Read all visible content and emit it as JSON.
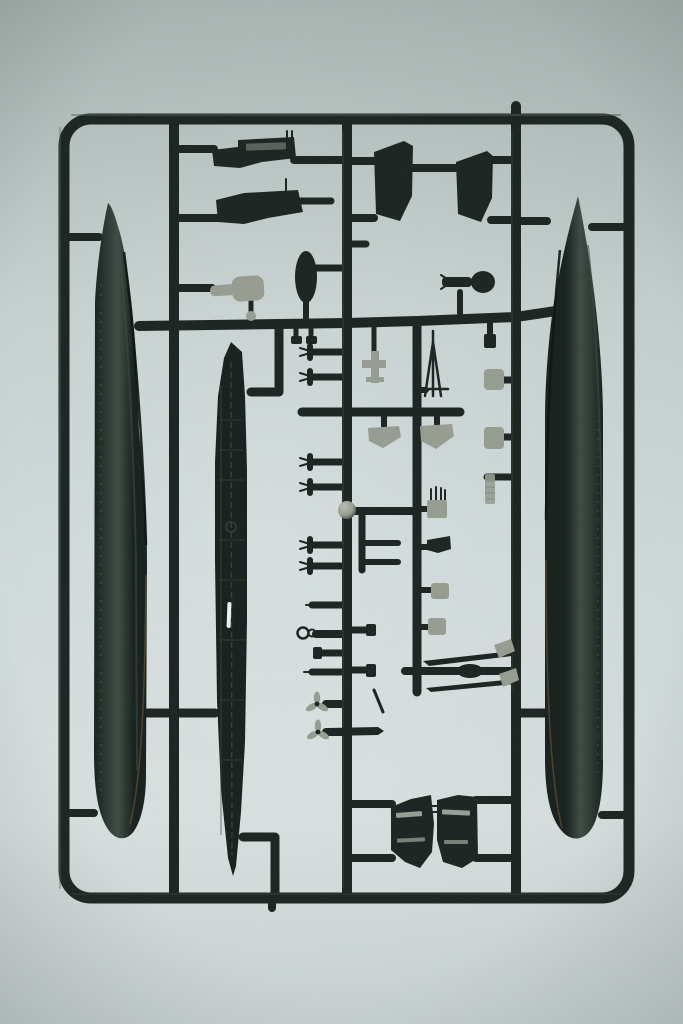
{
  "scene": {
    "type": "photograph",
    "subject": "ship-model-kit-sprue",
    "description": "Dark green injection-moulded plastic sprue holding ship model parts (two hull halves, full-length deck, funnels, deckhouses, masts, propellers, boats and small fittings) photographed on a plain light grey surface",
    "colors": {
      "bg_top": "#a4b0ad",
      "bg_upper": "#c2cdcc",
      "bg_mid": "#cdd7d8",
      "bg_lower": "#d4dcdc",
      "bg_bottom": "#c5cfce",
      "sprue_plastic": "#1a231f",
      "sprue_highlight": "#4d5d53",
      "hull_dark": "#161f1b",
      "hull_sheen": "#3d4b43",
      "hull_rim_warm": "#6b5134",
      "deck_detail": "#39443c",
      "grey_part": "#969c90",
      "grey_part_light": "#b7bcb2",
      "white_highlight": "#eef3f0"
    },
    "parts": [
      {
        "name": "sprue-frame"
      },
      {
        "name": "left-hull-half"
      },
      {
        "name": "right-hull-half"
      },
      {
        "name": "main-deck"
      },
      {
        "name": "forward-deckhouse"
      },
      {
        "name": "aft-deckhouse"
      },
      {
        "name": "funnel-a"
      },
      {
        "name": "funnel-b"
      },
      {
        "name": "dive-plane-grey"
      },
      {
        "name": "dive-plane-dark"
      },
      {
        "name": "conning-dome"
      },
      {
        "name": "tripod-mast"
      },
      {
        "name": "seaplane"
      },
      {
        "name": "ship-boat-a"
      },
      {
        "name": "ship-boat-b"
      },
      {
        "name": "life-raft-a"
      },
      {
        "name": "life-raft-b"
      },
      {
        "name": "range-finder-ball"
      },
      {
        "name": "gun-director"
      },
      {
        "name": "davit-cluster"
      },
      {
        "name": "anchor-fitting"
      },
      {
        "name": "windlass"
      },
      {
        "name": "mooring-ring"
      },
      {
        "name": "capstan"
      },
      {
        "name": "torpedo-spar-a"
      },
      {
        "name": "torpedo-spar-b"
      },
      {
        "name": "accommodation-ladder"
      },
      {
        "name": "propeller-a"
      },
      {
        "name": "propeller-b"
      },
      {
        "name": "propeller-shaft"
      },
      {
        "name": "bridge-block-a"
      },
      {
        "name": "bridge-block-b"
      }
    ]
  }
}
